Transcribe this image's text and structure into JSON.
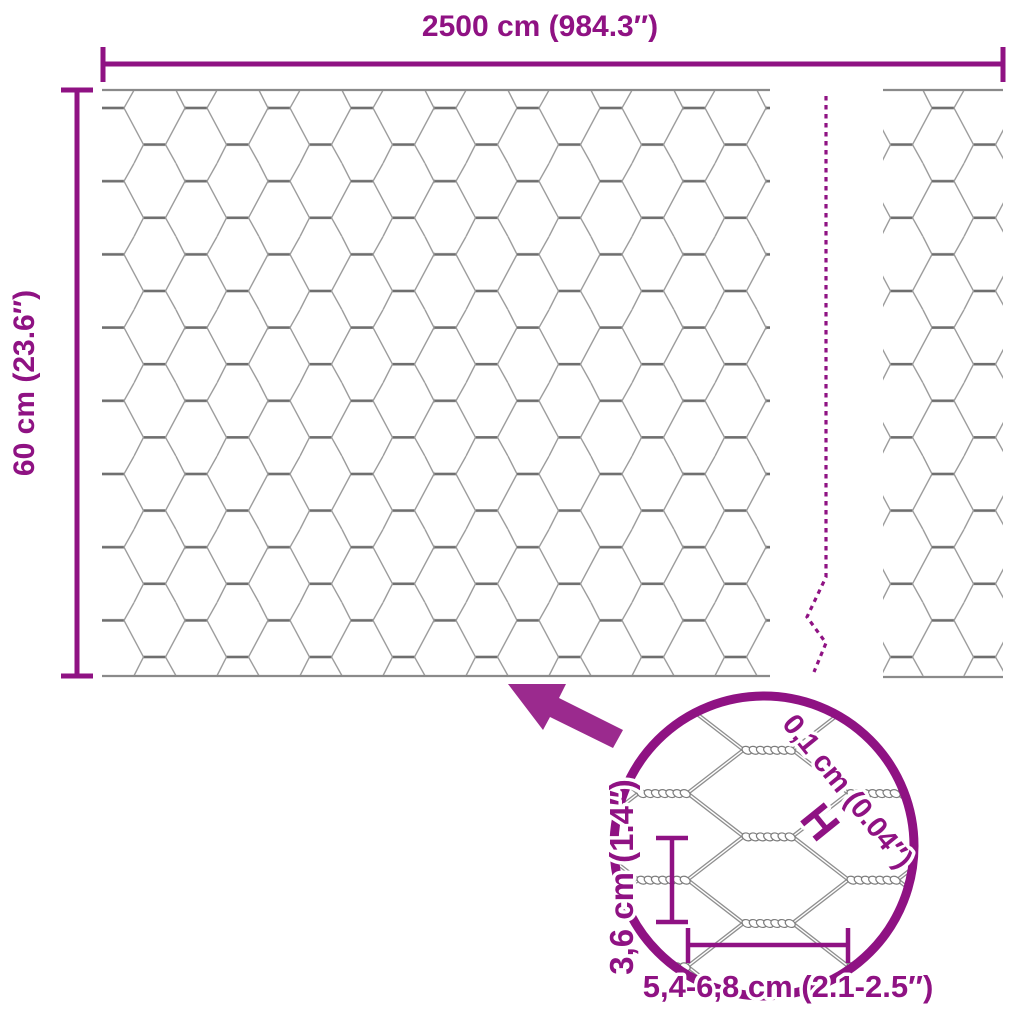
{
  "labels": {
    "total_width": "2500 cm (984.3″)",
    "total_height": "60 cm (23.6″)",
    "wire_thickness": "0,1 cm (0.04″)",
    "wire_thickness_symbol": "H",
    "mesh_height": "3,6 cm (1.4″)",
    "mesh_width": "5,4-6,8 cm (2.1-2.5″)"
  },
  "colors": {
    "purple": "#8F1283",
    "arrow": "#9B2A8E",
    "wire": "#9B9B9B",
    "wire_dark": "#6E6E6E",
    "panel_border": "#8A8A8A",
    "background": "#FFFFFF"
  }
}
